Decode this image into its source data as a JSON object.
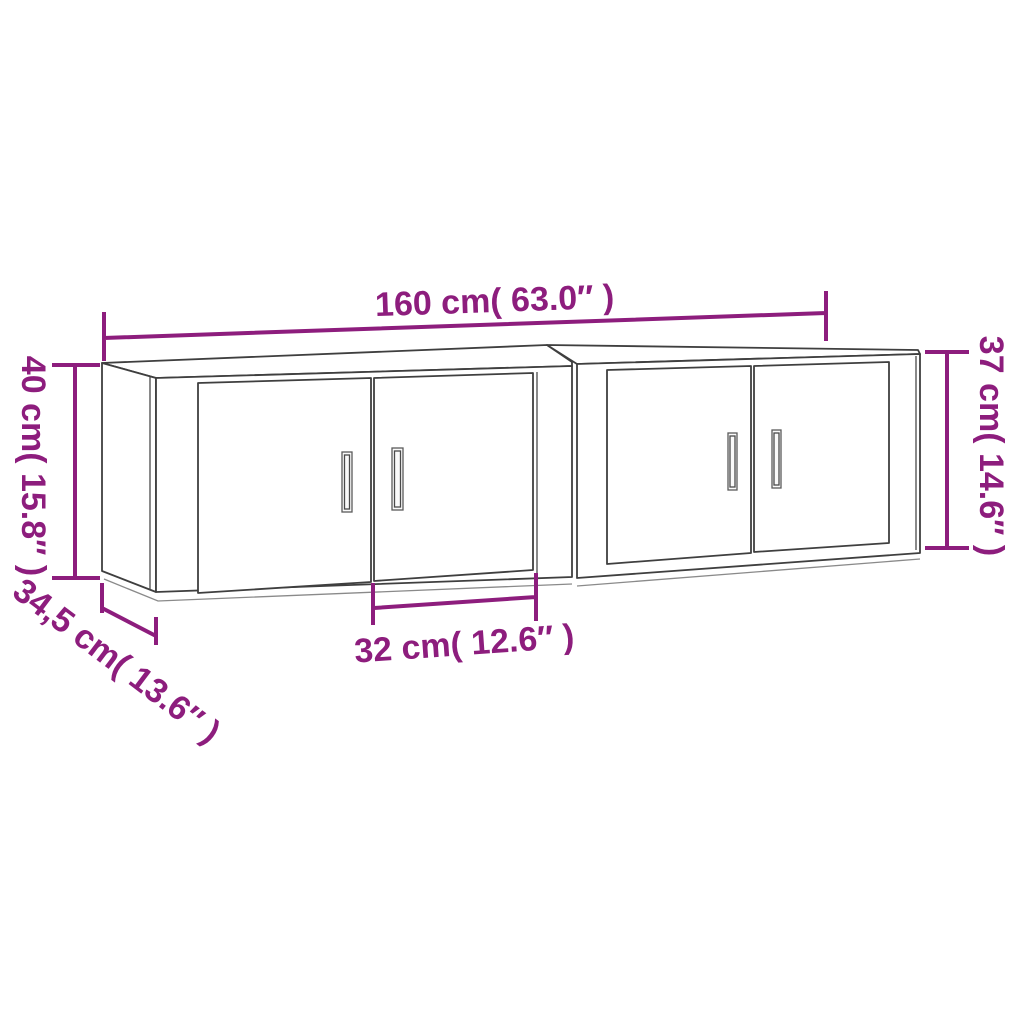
{
  "diagram": {
    "type": "furniture-dimension-diagram",
    "background": "#ffffff",
    "colors": {
      "dimension": "#8d1d7d",
      "outline": "#3f3f3f"
    },
    "labels": {
      "total_width": "160 cm( 63.0″ )",
      "left_height": "40 cm( 15.8″ )",
      "right_height": "37 cm( 14.6″ )",
      "depth": "34,5 cm( 13.6″ )",
      "door_width": "32 cm( 12.6″ )"
    }
  }
}
